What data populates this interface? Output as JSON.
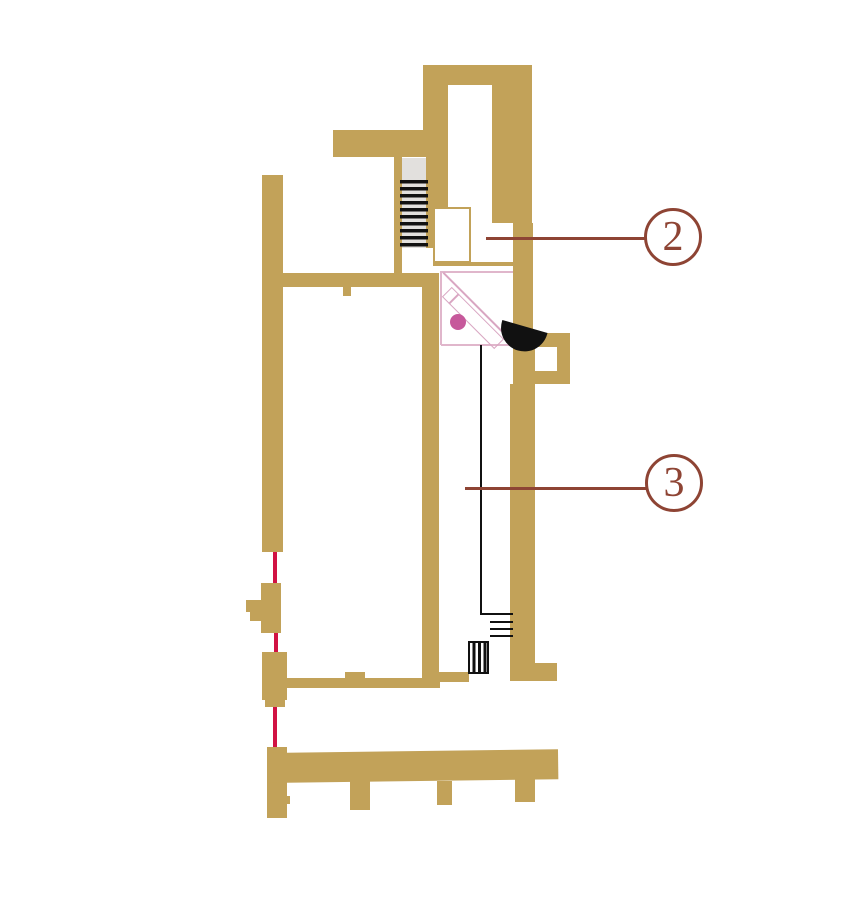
{
  "callouts": [
    {
      "label": "2"
    },
    {
      "label": "3"
    }
  ],
  "colors": {
    "background": "#ffffff",
    "wall": "#C2A259",
    "callout": "#8E4434",
    "section-line": "#D11243",
    "pink-line": "#E0B6CB",
    "pink-band": "#D9A6C2",
    "pink-dot": "#C6589B",
    "stair-bg": "#E2E0DD",
    "ink": "#111111"
  }
}
